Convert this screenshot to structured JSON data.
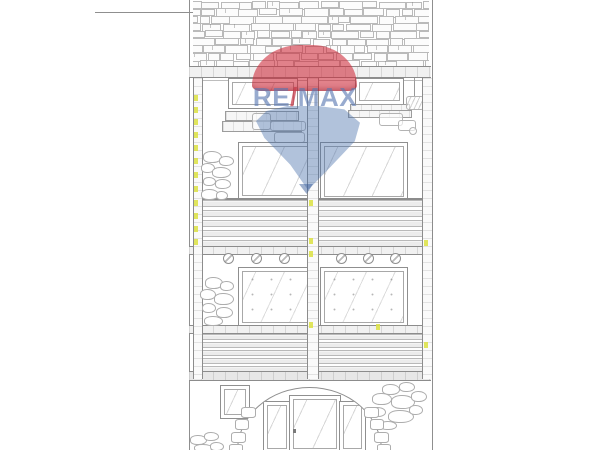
{
  "watermark": {
    "re": "RE",
    "slash": "/",
    "max": "MAX",
    "balloon_red": "rgba(205,40,55,0.58)",
    "balloon_blue": "rgba(70,110,170,0.42)",
    "text_blue": "rgba(88,120,178,0.62)",
    "slash_red": "rgba(200,60,75,0.75)"
  },
  "drawing": {
    "paper_color": "#ffffff",
    "line_color": "#8f8f8f",
    "soft_line_color": "#bdbdbd",
    "highlight_color": "#dde24b",
    "alt_text": "Line-sketch elevation of a narrow house: brick gable roof, two balcony floors with slatted railings and glass doors, arched ground-floor entrance with door and side lights, stone texture patches"
  }
}
